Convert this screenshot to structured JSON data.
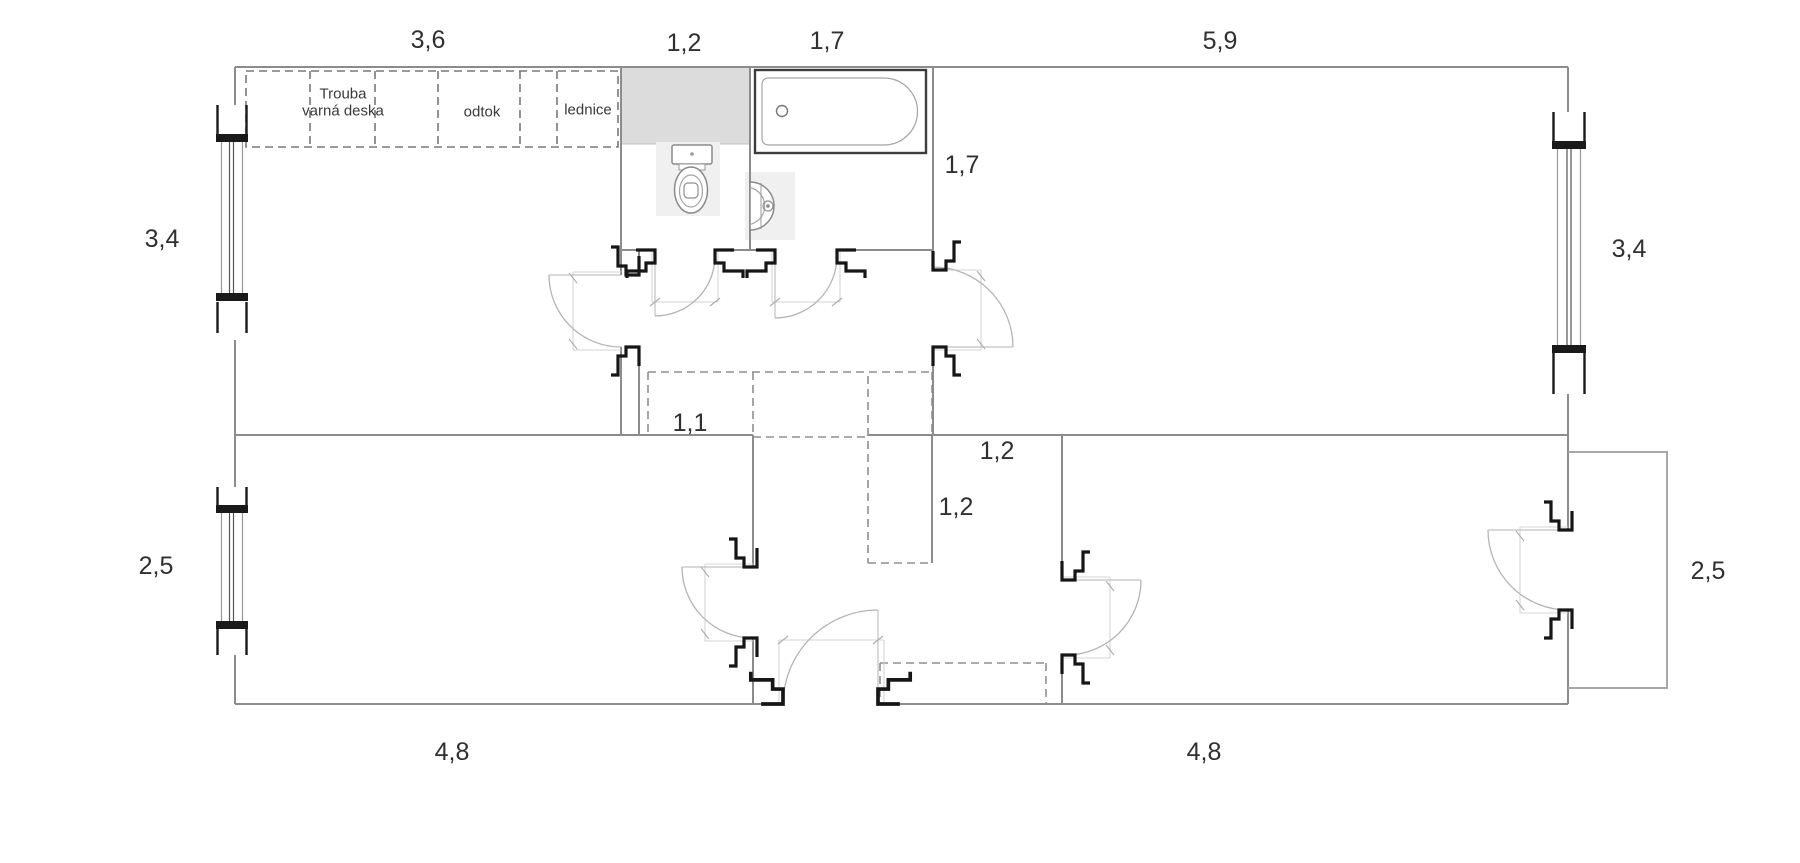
{
  "dims": {
    "kitchen_width": "3,6",
    "wc_width": "1,2",
    "bathroom_width": "1,7",
    "large_room_width": "5,9",
    "bathroom_depth": "1,7",
    "upper_left_height": "3,4",
    "upper_right_height": "3,4",
    "corridor_width": "1,1",
    "hall_opening_width": "1,2",
    "hall_opening_depth": "1,2",
    "lower_left_height": "2,5",
    "lower_right_height": "2,5",
    "bedroom_left_width": "4,8",
    "bedroom_right_width": "4,8"
  },
  "kitchen": {
    "oven": "Trouba",
    "hob": "varná deska",
    "drain": "odtok",
    "fridge": "lednice"
  },
  "colors": {
    "wall": "#8c8c8c",
    "door_jamb": "#161616",
    "counter_fill": "#dcdcdc",
    "swing_arc": "#b4b4b4",
    "text": "#303030"
  }
}
